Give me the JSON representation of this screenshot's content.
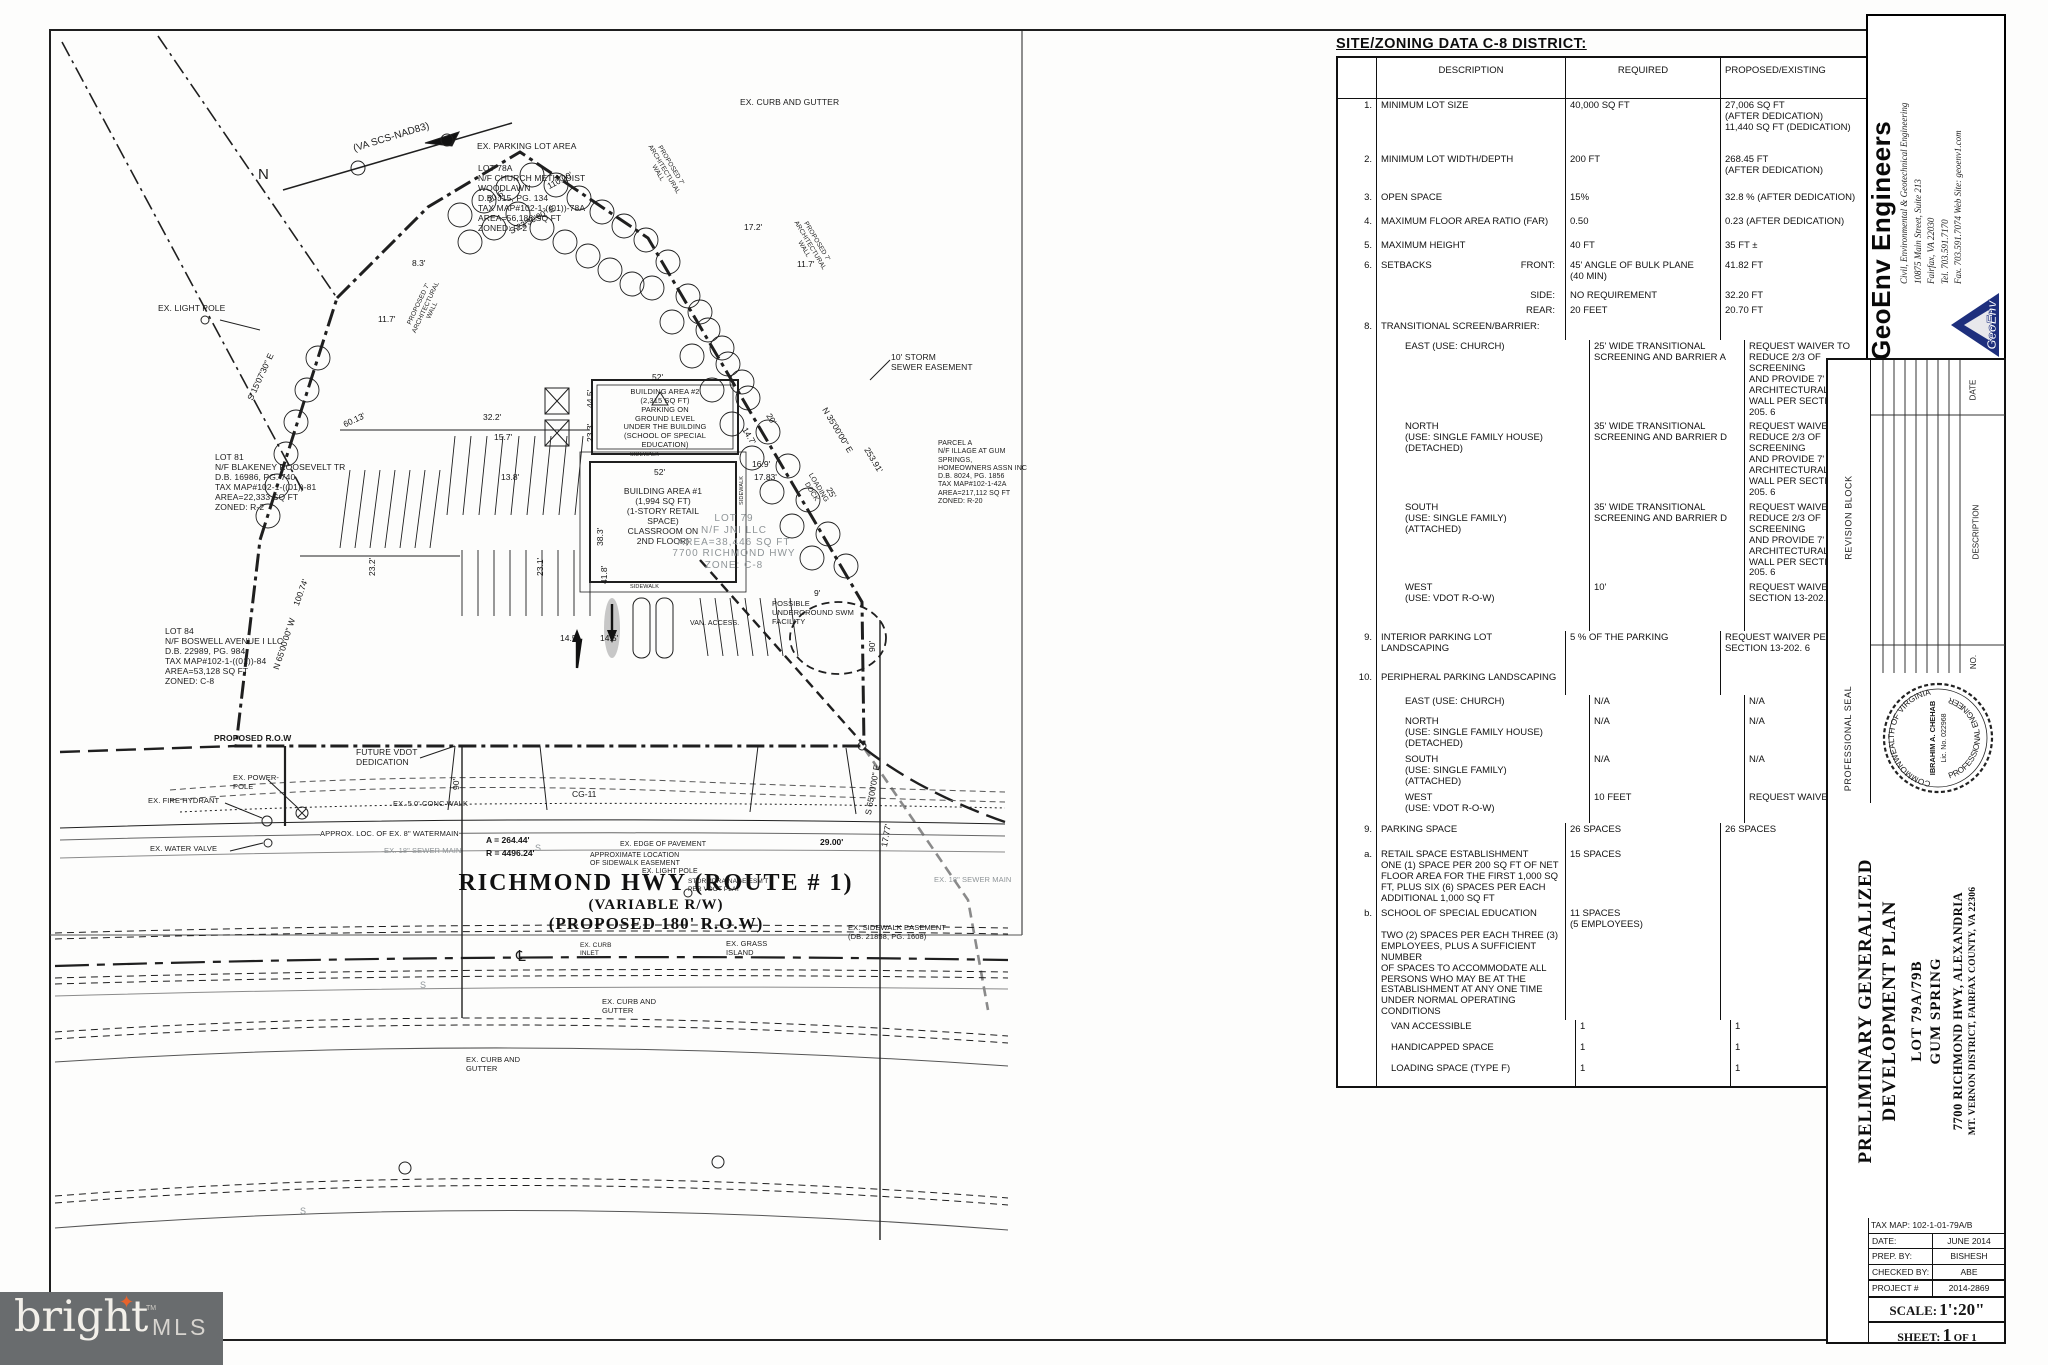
{
  "zoning_table": {
    "title": "SITE/ZONING DATA C-8 DISTRICT:",
    "columns": [
      "",
      "DESCRIPTION",
      "REQUIRED",
      "PROPOSED/EXISTING"
    ],
    "rows": [
      {
        "num": "1.",
        "desc": "MINIMUM LOT SIZE",
        "sub": "",
        "req": "40,000 SQ FT",
        "prop": "27,006 SQ FT\n(AFTER DEDICATION)\n11,440 SQ FT (DEDICATION)"
      },
      {
        "num": "2.",
        "desc": "MINIMUM LOT WIDTH/DEPTH",
        "sub": "",
        "req": "200 FT",
        "prop": "268.45 FT\n(AFTER DEDICATION)"
      },
      {
        "num": "3.",
        "desc": "OPEN SPACE",
        "sub": "",
        "req": "15%",
        "prop": "32.8 % (AFTER DEDICATION)"
      },
      {
        "num": "4.",
        "desc": "MAXIMUM FLOOR AREA RATIO (FAR)",
        "sub": "",
        "req": "0.50",
        "prop": "0.23 (AFTER DEDICATION)"
      },
      {
        "num": "5.",
        "desc": "MAXIMUM HEIGHT",
        "sub": "",
        "req": "40 FT",
        "prop": "35 FT ±"
      },
      {
        "num": "6.",
        "desc": "SETBACKS",
        "sub": "FRONT:",
        "req": "45' ANGLE OF BULK PLANE\n(40 MIN)",
        "prop": "41.82 FT"
      },
      {
        "num": "",
        "desc": "",
        "sub": "SIDE:",
        "req": "NO REQUIREMENT",
        "prop": "32.20 FT"
      },
      {
        "num": "",
        "desc": "",
        "sub": "REAR:",
        "req": "20 FEET",
        "prop": "20.70 FT"
      },
      {
        "num": "8.",
        "desc": "TRANSITIONAL SCREEN/BARRIER:",
        "sub": "",
        "req": "",
        "prop": ""
      },
      {
        "num": "",
        "desc": "EAST (USE: CHURCH)",
        "sub": "",
        "req": "25' WIDE TRANSITIONAL\nSCREENING AND BARRIER A",
        "prop": "REQUEST WAIVER TO\nREDUCE 2/3 OF SCREENING\nAND PROVIDE 7' ARCHITECTURAL\nWALL PER SECTION 13-205. 6"
      },
      {
        "num": "",
        "desc": "NORTH\n(USE: SINGLE FAMILY HOUSE)\n(DETACHED)",
        "sub": "",
        "req": "35' WIDE TRANSITIONAL\nSCREENING AND BARRIER D",
        "prop": "REQUEST WAIVER TO\nREDUCE 2/3 OF SCREENING\nAND PROVIDE 7' ARCHITECTURAL\nWALL PER SECTION 13-205. 6"
      },
      {
        "num": "",
        "desc": "SOUTH\n(USE: SINGLE FAMILY)\n(ATTACHED)",
        "sub": "",
        "req": "35' WIDE TRANSITIONAL\nSCREENING AND BARRIER D",
        "prop": "REQUEST WAIVER TO\nREDUCE 2/3 OF SCREENING\nAND PROVIDE 7' ARCHITECTURAL\nWALL PER SECTION 13-205. 6"
      },
      {
        "num": "",
        "desc": "WEST\n(USE: VDOT R-O-W)",
        "sub": "",
        "req": "10'",
        "prop": "REQUEST WAIVER PER\nSECTION 13-202. 6"
      },
      {
        "num": "9.",
        "desc": "INTERIOR PARKING LOT LANDSCAPING",
        "sub": "",
        "req": "5 % OF THE PARKING",
        "prop": "REQUEST WAIVER PER\nSECTION 13-202. 6"
      },
      {
        "num": "10.",
        "desc": "PERIPHERAL PARKING LANDSCAPING",
        "sub": "",
        "req": "",
        "prop": ""
      },
      {
        "num": "",
        "desc": "EAST (USE: CHURCH)",
        "sub": "",
        "req": "N/A",
        "prop": "N/A"
      },
      {
        "num": "",
        "desc": "NORTH\n(USE: SINGLE FAMILY HOUSE)\n(DETACHED)",
        "sub": "",
        "req": "N/A",
        "prop": "N/A"
      },
      {
        "num": "",
        "desc": "SOUTH\n(USE: SINGLE FAMILY)\n(ATTACHED)",
        "sub": "",
        "req": "N/A",
        "prop": "N/A"
      },
      {
        "num": "",
        "desc": "WEST\n(USE: VDOT R-O-W)",
        "sub": "",
        "req": "10 FEET",
        "prop": "REQUEST WAIVER"
      },
      {
        "num": "9.",
        "desc": "PARKING SPACE",
        "sub": "",
        "req": "26 SPACES",
        "prop": "26 SPACES"
      },
      {
        "num": "a.",
        "desc": "RETAIL SPACE ESTABLISHMENT\nONE (1) SPACE PER 200 SQ FT OF NET\nFLOOR AREA FOR THE FIRST 1,000 SQ\nFT, PLUS SIX (6) SPACES PER EACH\nADDITIONAL 1,000  SQ FT",
        "sub": "",
        "req": "15 SPACES",
        "prop": ""
      },
      {
        "num": "b.",
        "desc": "SCHOOL OF SPECIAL EDUCATION\n\nTWO (2) SPACES PER EACH THREE (3)\nEMPLOYEES, PLUS A SUFFICIENT NUMBER\nOF SPACES TO ACCOMMODATE ALL\nPERSONS WHO MAY BE AT THE\nESTABLISHMENT AT ANY ONE TIME\nUNDER NORMAL OPERATING CONDITIONS",
        "sub": "",
        "req": "11 SPACES\n(5 EMPLOYEES)",
        "prop": ""
      },
      {
        "num": "",
        "desc": "VAN ACCESSIBLE",
        "sub": "",
        "req": "1",
        "prop": "1"
      },
      {
        "num": "",
        "desc": "HANDICAPPED SPACE",
        "sub": "",
        "req": "1",
        "prop": "1"
      },
      {
        "num": "",
        "desc": "LOADING SPACE (TYPE F)",
        "sub": "",
        "req": "1",
        "prop": "1"
      }
    ]
  },
  "plan": {
    "north_label": "N",
    "datum": "(VA SCS-NAD83)",
    "labels": {
      "ex_parking": "EX. PARKING LOT AREA",
      "curb_gutter": "EX. CURB AND GUTTER",
      "lot78a": "LOT 78A\nN/F CHURCH METHODIST\nWOODLAWN\nD.B. J15, PG. 134\nTAX MAP#102-1-((01))-78A\nAREA=56,186 SQ FT\nZONED: R-2",
      "lot81": "LOT 81\nN/F BLAKENEY ROOSEVELT TR\nD.B. 16986, PG. 740\nTAX MAP#102-1-((01))-81\nAREA=22,333 SQ FT\nZONED: R-2",
      "lot84": "LOT 84\nN/F BOSWELL AVENUE I LLC\nD.B. 22989, PG. 984\nTAX MAP#102-1-((01))-84\nAREA=53,128 SQ FT\nZONED: C-8",
      "parcel_a": "PARCEL A\nN/F ILLAGE AT GUM SPRINGS,\nHOMEOWNERS ASSN INC\nD.B. 8024, PG. 1856\nTAX MAP#102-1-42A\nAREA=217,112 SQ FT\nZONED: R-20",
      "lot79": "LOT 79\nN/F JNI LLC\nAREA=38,446 SQ FT\n7700 RICHMOND HWY\nZONE: C-8",
      "storm_esmt10": "10' STORM\nSEWER EASEMENT",
      "bldg2": "BUILDING AREA #2\n(2,315 SQ FT)\nPARKING ON\nGROUND LEVEL\nUNDER THE BUILDING\n(SCHOOL OF SPECIAL\nEDUCATION)",
      "bldg1": "BUILDING AREA #1\n(1,994 SQ FT)\n(1-STORY RETAIL\nSPACE)\nCLASSROOM ON\n2ND FLOOR)",
      "sidewalk": "SIDEWALK",
      "swm": "POSSIBLE\nUNDERGROUND SWM\nFACILITY",
      "van": "VAN. ACCESS.",
      "loading": "LOADING\nDOCK",
      "proposed_row": "PROPOSED R.O.W",
      "future_vdot": "FUTURE VDOT\nDEDICATION",
      "power_pole": "EX. POWER-\nPOLE",
      "fire_hydrant": "EX. FIRE HYDRANT",
      "water_valve": "EX. WATER VALVE",
      "conc_walk": "EX. 5.0' CONC WALK",
      "watermain": "APPROX. LOC. OF EX. 8\" WATERMAIN",
      "sewer18": "EX. 18\" SEWER MAIN",
      "approx_sidewalk": "APPROXIMATE LOCATION\nOF SIDEWALK EASEMENT",
      "hwy1": "RICHMOND HWY (ROUTE # 1)",
      "hwy2": "(VARIABLE R/W)",
      "hwy3": "(PROPOSED 180' R.O.W)",
      "curb_inlet": "EX. CURB\nINLET",
      "grass_island": "EX. GRASS\nISLAND",
      "curb_gutter2": "EX. CURB AND\nGUTTER",
      "sidewalk_esmt": "EX. SIDEWALK EASEMENT\n(DB. 21858, PG. 1608)",
      "storm_drain_esmt": "STORMDRAINAGE ESM'T\nPER VDOT PLAT",
      "light_pole": "EX. LIGHT POLE",
      "edge_pavement": "EX. EDGE OF PAVEMENT",
      "arch_wall": "PROPOSED 7'\nARCHITECTURAL\nWALL",
      "cl_sym": "℄",
      "s_marker": "S"
    },
    "dims": [
      "8.3'",
      "11.7'",
      "17.2'",
      "11.7'",
      "20.6'",
      "110.00'",
      "S 23'30'00\" E",
      "S 15'07'30\" E",
      "100.74'",
      "N 65'00'00\" W",
      "60.13'",
      "N 35'00'00\" E",
      "253.91'",
      "52'",
      "52'",
      "44.5'",
      "23.3'",
      "38.3'",
      "16.9'",
      "17.83'",
      "14.7'",
      "20'",
      "25'",
      "23.1'",
      "41.8'",
      "32.2'",
      "15.7'",
      "13.8'",
      "14.5'",
      "14.5'",
      "9'",
      "90'",
      "90'",
      "29.00'",
      "S 65'00'00\" E",
      "17.77'",
      "CG-11",
      "A = 264.44'",
      "R = 4496.24'",
      "23.2'"
    ]
  },
  "titleblock": {
    "firm": {
      "name": "GeoEnv Engineers",
      "logo_text": "GeoEnv",
      "tagline": "Civil, Environmental & Geotechnical Engineering",
      "address1": "10875 Main Street, Suite 213",
      "address2": "Fairfax, VA  22030",
      "tel": "Tel.  703.591.7170",
      "fax": "Fax. 703.591.7074    Web Site:  geoenv1.com"
    },
    "revision": {
      "caption": "REVISION BLOCK",
      "col_date": "DATE",
      "col_desc": "DESCRIPTION",
      "col_no": "NO."
    },
    "seal": {
      "caption": "PROFESSIONAL SEAL",
      "arc_top": "COMMONWEALTH OF VIRGINIA",
      "name": "IBRAHIM A. CHEHAB",
      "lic": "Lic. No. 022968",
      "arc_bottom": "PROFESSIONAL ENGINEER"
    },
    "title": {
      "line1": "PRELIMINARY GENERALIZED",
      "line2": "DEVELOPMENT PLAN",
      "line3": "LOT 79A/79B",
      "line4": "GUM SPRING",
      "line5": "7700 RICHMOND HWY, ALEXANDRIA",
      "line6": "MT. VERNON DISTRICT, FAIRFAX COUNTY, VA 22306"
    },
    "info": {
      "tax_map": "TAX MAP: 102-1-01-79A/B",
      "date_label": "DATE:",
      "date": "JUNE 2014",
      "prep_label": "PREP. BY:",
      "prep": "BISHESH",
      "checked_label": "CHECKED BY:",
      "checked": "ABE",
      "project_label": "PROJECT #",
      "project": "2014-2869",
      "scale_label": "SCALE:",
      "scale": "1':20\"",
      "sheet_label": "SHEET:",
      "sheet_num": "1",
      "sheet_of": "OF 1"
    }
  },
  "watermark": {
    "brand": "bright",
    "tm": "TM",
    "suffix": "MLS",
    "star": "✦",
    "colors": {
      "box": "#696c6e",
      "text": "#f3f0ea",
      "star": "#e8632c",
      "logo_blue": "#1e2f7d"
    }
  }
}
